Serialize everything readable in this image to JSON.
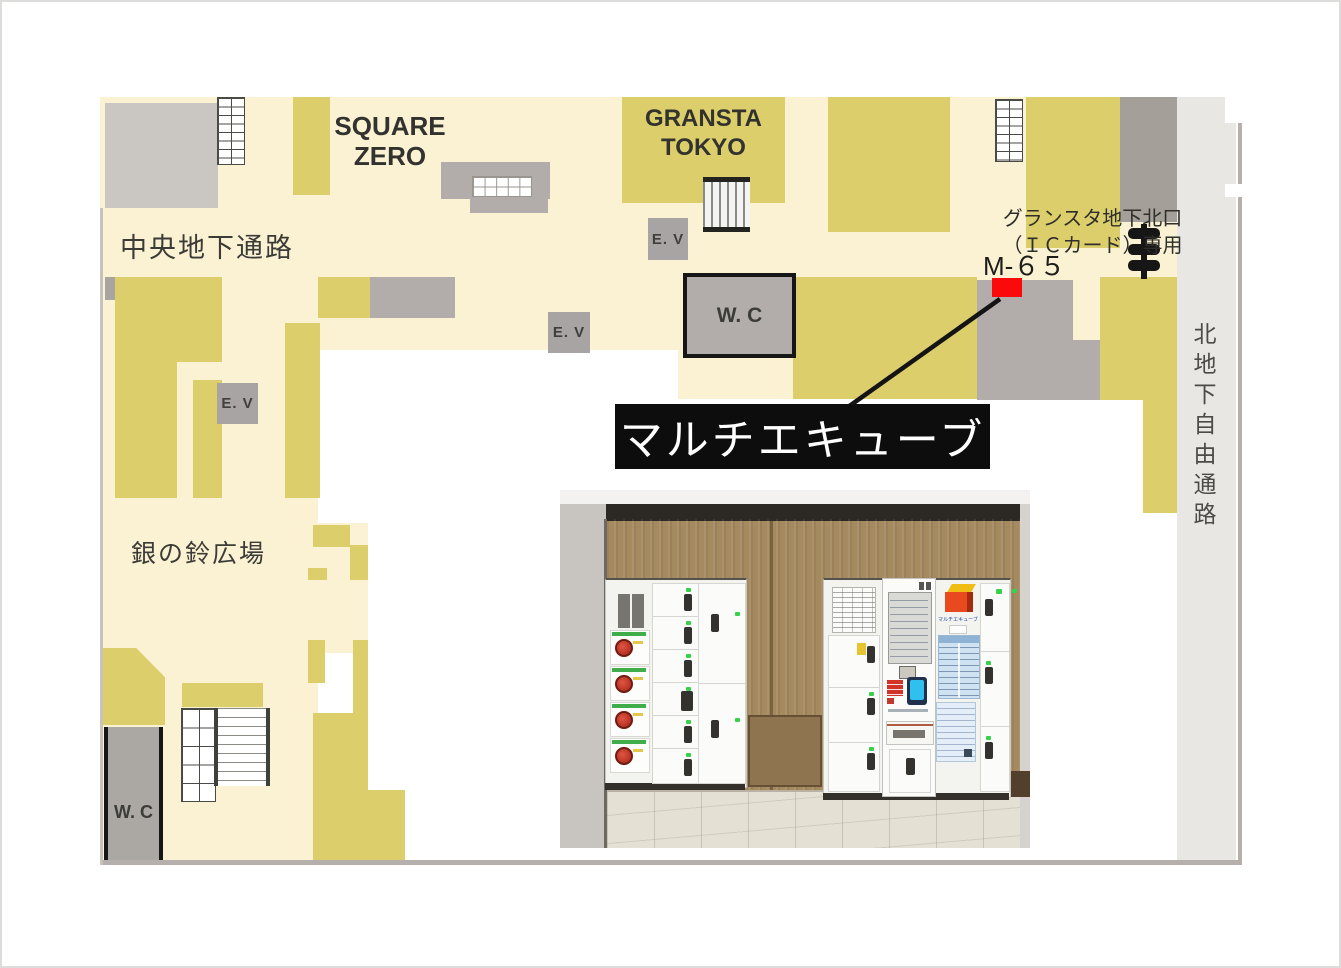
{
  "map": {
    "labels": {
      "central_passage": "中央地下通路",
      "square_zero_lines": [
        "SQUARE",
        "ZERO"
      ],
      "gransta_lines": [
        "GRANSTA",
        "TOKYO"
      ],
      "north_gate_lines": [
        "グランスタ地下北口",
        "（ＩＣカード）専用"
      ],
      "locker_code": "M-６５",
      "north_free_passage": "北地下自由通路",
      "gin_no_suzu": "銀の鈴広場",
      "elevator": "E. V",
      "toilet": "W. C",
      "callout": "マルチエキューブ"
    },
    "colors": {
      "floor_beige": "#fbf1d3",
      "shop_yellow": "#ddce6c",
      "facility_gray": "#b2adaa",
      "passage_gray": "#e9e7e3",
      "marker_red": "#fa0a0a",
      "callout_bg": "#0d0d0d",
      "callout_text": "#ffffff"
    }
  },
  "photo": {
    "cube_label": "マルチエキューブ"
  }
}
